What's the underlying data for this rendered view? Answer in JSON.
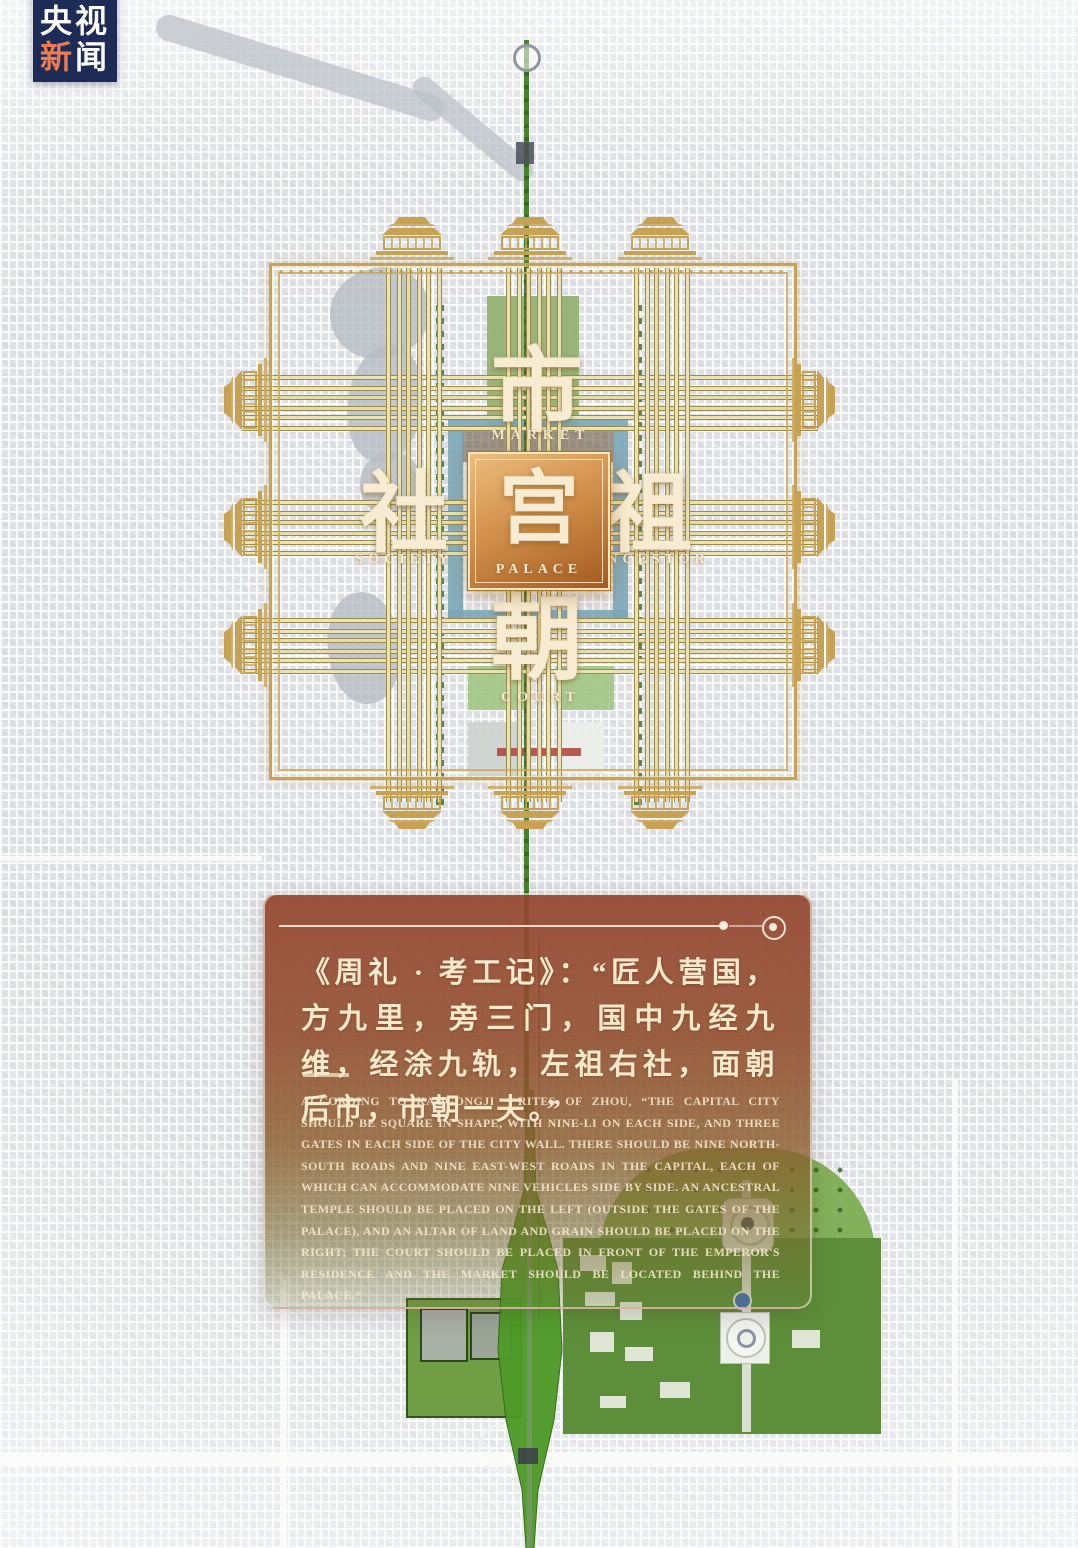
{
  "logo": {
    "row1": "央视",
    "row2_accent": "新",
    "row2_rest": "闻"
  },
  "map_labels": {
    "market": {
      "zh": "市",
      "en": "MARKET"
    },
    "society": {
      "zh": "社",
      "en": "SOCIETY"
    },
    "palace": {
      "zh": "宫",
      "en": "PALACE"
    },
    "ancestor": {
      "zh": "祖",
      "en": "ANCESTOR"
    },
    "court": {
      "zh": "朝",
      "en": "COURT"
    }
  },
  "panel": {
    "quote_zh": "《周礼 · 考工记》：“匠人营国，方九里，旁三门，国中九经九维，经涂九轨，左祖右社，面朝后市，市朝一夫。”",
    "quote_en": "ACCORDING TO KAOGONGJI · RITES OF ZHOU, “THE CAPITAL CITY SHOULD BE SQUARE IN SHAPE, WITH NINE-LI ON EACH SIDE, AND THREE GATES IN EACH SIDE OF THE CITY WALL. THERE SHOULD BE NINE NORTH-SOUTH ROADS AND NINE EAST-WEST ROADS IN THE CAPITAL, EACH OF WHICH CAN ACCOMMODATE NINE VEHICLES SIDE BY SIDE. AN ANCESTRAL TEMPLE SHOULD BE PLACED ON THE LEFT (OUTSIDE THE GATES OF THE PALACE), AND AN ALTAR OF LAND AND GRAIN SHOULD BE PLACED ON THE RIGHT; THE COURT SHOULD BE PLACED IN FRONT OF THE EMPEROR'S RESIDENCE AND THE MARKET SHOULD BE LOCATED BEHIND THE PALACE.”"
  },
  "colors": {
    "gold": "#c7a255",
    "gold_pale": "#ece3b0",
    "panel_red": "#94462f",
    "cream": "#f7e9ca",
    "logo_navy": "#1d2b57",
    "logo_accent": "#ee7c52",
    "park_green": "#5d8f3a",
    "axis_green": "#417d26",
    "palace_bronze": "#c08040"
  }
}
